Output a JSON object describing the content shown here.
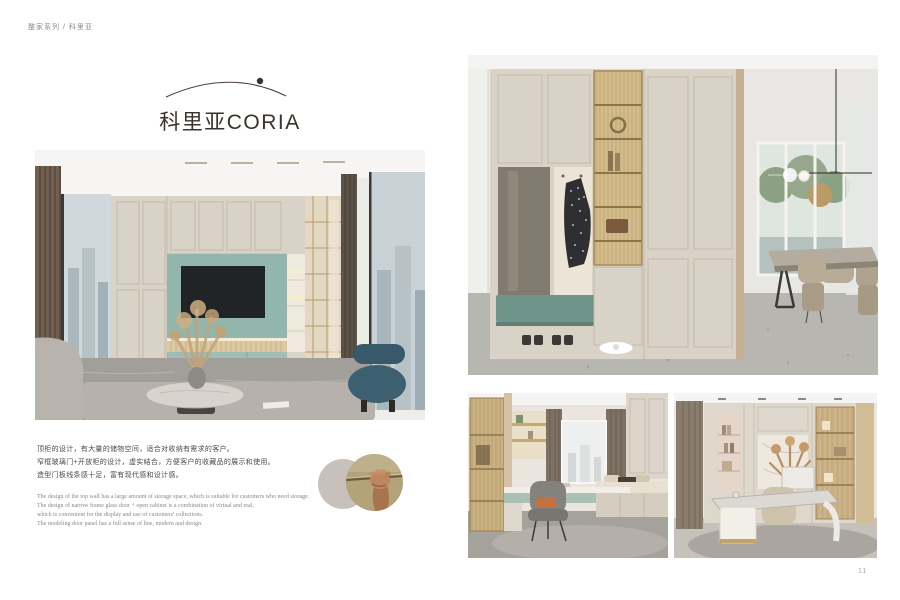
{
  "page": {
    "breadcrumb": "整家系列 / 科里亚",
    "number": "11"
  },
  "logo": {
    "title": "科里亚CORIA"
  },
  "description": {
    "cn_lines": [
      "顶柜的设计，有大量的储物空间，适合对收纳有需求的客户。",
      "窄框玻璃门+开放柜的设计，虚实结合，方便客户的收藏品的展示和使用。",
      "造型门板线条感十足，富有现代感和设计感。"
    ],
    "en_lines": [
      "The design of the top wall has a large amount of storage space, which is suitable for customers who need storage.",
      "The design of narrow frame glass door + open cabinet is a combination of virtual and real,",
      "which is convenient for the display and use of customers' collections.",
      "The modeling door panel has a full sense of line, modern and design."
    ]
  },
  "palette": {
    "cabinet_cream": "#d9d2c7",
    "tv_alcove_teal": "#92b5ac",
    "bench_teal": "#6f9489",
    "fluted_glass_gold": "#c9b180",
    "logo_text": "#3a322c",
    "body_text": "#4d4a46",
    "muted_text": "#8c8984"
  }
}
